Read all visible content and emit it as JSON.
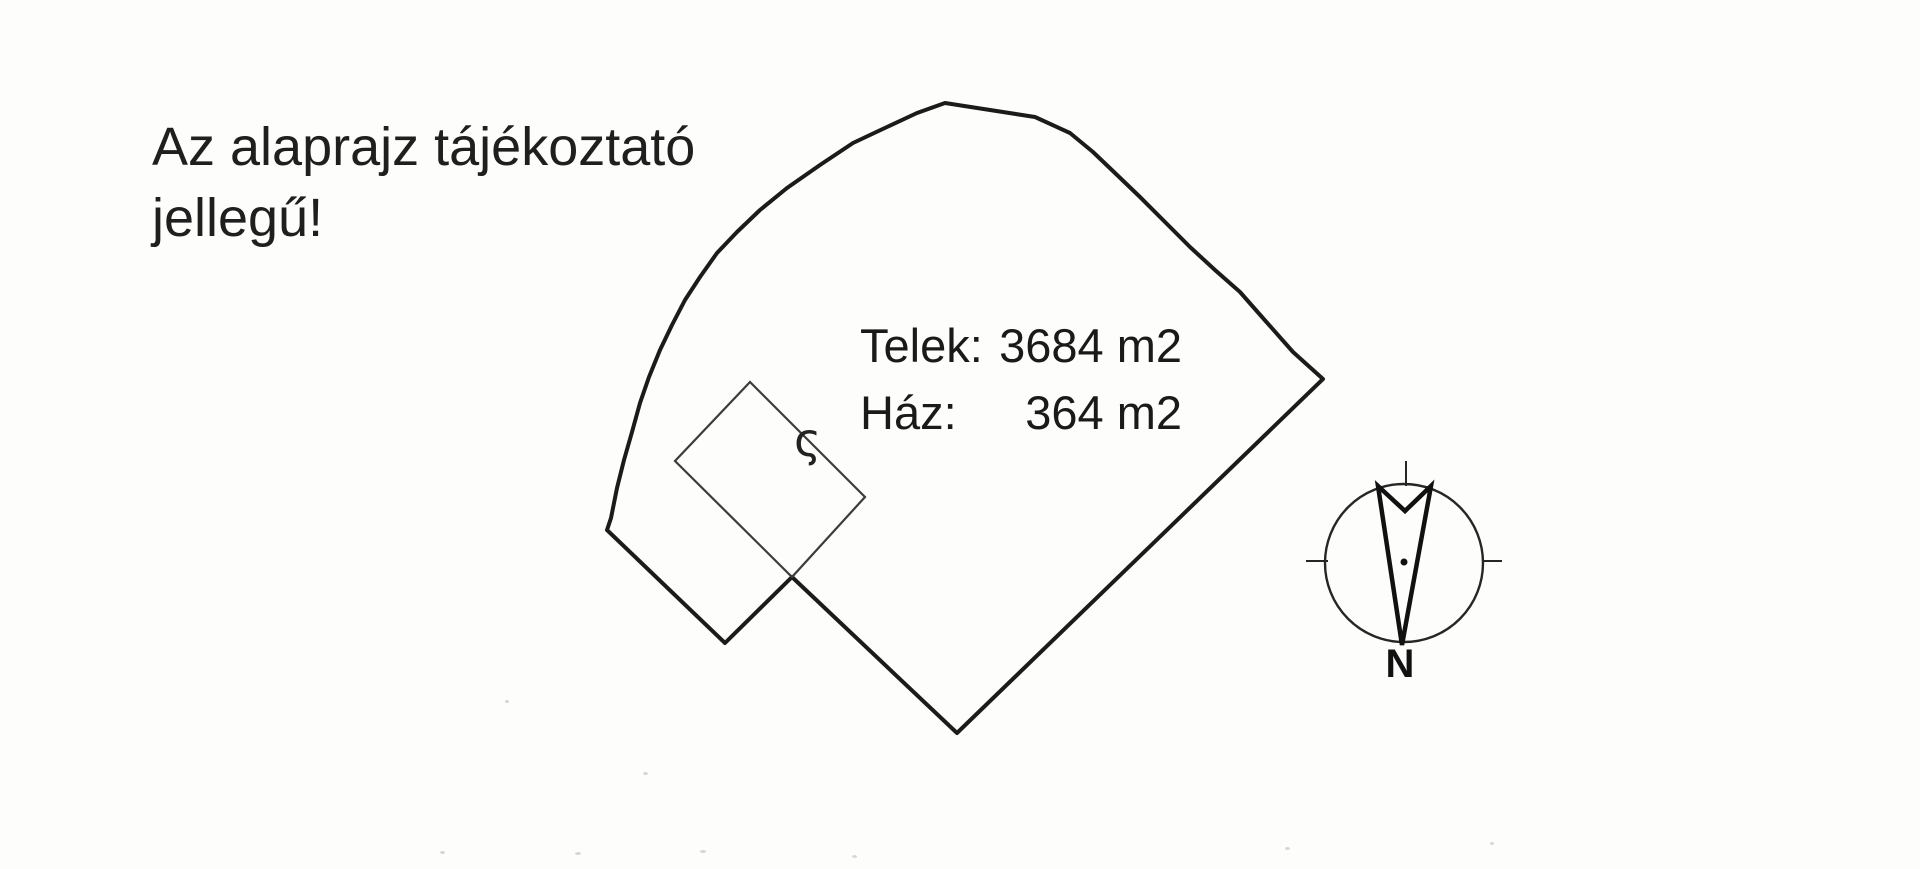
{
  "page": {
    "background": "#fdfdfc",
    "ink": "#1b1b1b"
  },
  "disclaimer": {
    "line1": "Az alaprajz tájékoztató",
    "line2": "jellegű!"
  },
  "areas": {
    "plot_label": "Telek:",
    "plot_value": "3684 m2",
    "house_label": "Ház:",
    "house_value": "364 m2"
  },
  "plan": {
    "plot_outline_points": "945,103 1035,117 1070,133 1093,152 1115,173 1140,197 1165,222 1190,247 1215,270 1240,292 1262,317 1293,352 1323,379 957,733 792,577 725,643 607,530 611,518 617,488 624,460 632,432 640,403 649,377 660,350 672,325 685,300 700,277 717,253 737,232 760,210 787,188 820,165 853,143 887,127 917,113",
    "house_outline_points": "750,382 865,497 792,577 675,461",
    "survey_mark": "ς"
  },
  "compass": {
    "north_label": "N"
  }
}
